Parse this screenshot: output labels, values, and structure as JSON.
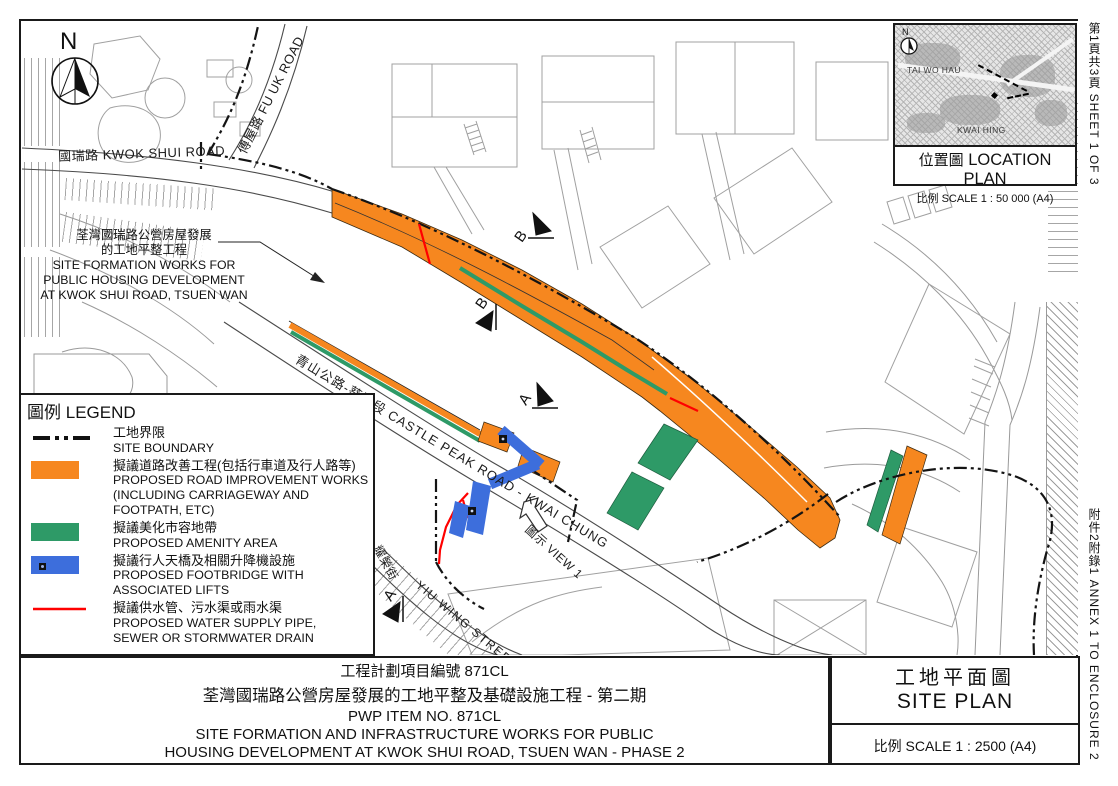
{
  "colors": {
    "road_improvement_orange": "#F6871F",
    "amenity_green": "#2E9A67",
    "footbridge_blue": "#3D6EDC",
    "pipe_red": "#FF0000",
    "boundary_black": "#1A1A1A"
  },
  "north": "N",
  "margin_notes": {
    "sheet": "第1頁共3頁  SHEET 1 OF 3",
    "annex": "附件2附錄1  ANNEX 1 TO ENCLOSURE 2"
  },
  "location_plan": {
    "north": "N",
    "area_label_1": "TAI WO HAU",
    "area_label_2": "KWAI HING",
    "title_zh": "位置圖",
    "title_en": "LOCATION PLAN",
    "scale": "比例 SCALE 1 : 50 000 (A4)"
  },
  "map_labels": {
    "kwok_shui_road": "國瑞路 KWOK SHUI ROAD",
    "fu_uk_road": "傅屋路 FU UK ROAD",
    "castle_peak_road": "青山公路-葵涌段  CASTLE PEAK ROAD - KWAI CHUNG",
    "yiu_wing_street_zh": "耀榮街",
    "yiu_wing_street_en": "YIU WING STREET",
    "view1": "圖示 VIEW 1",
    "section_a": "A",
    "section_b": "B",
    "site_annotation_1": "荃灣國瑞路公營房屋發展",
    "site_annotation_2": "的工地平整工程",
    "site_annotation_3": "SITE FORMATION WORKS FOR",
    "site_annotation_4": "PUBLIC HOUSING DEVELOPMENT",
    "site_annotation_5": "AT KWOK SHUI ROAD, TSUEN WAN"
  },
  "legend": {
    "title_zh": "圖例",
    "title_en": "LEGEND",
    "items": [
      {
        "key": "site-boundary",
        "zh": "工地界限",
        "en": [
          "SITE BOUNDARY"
        ]
      },
      {
        "key": "road-improvement",
        "zh": "擬議道路改善工程(包括行車道及行人路等)",
        "en": [
          "PROPOSED ROAD IMPROVEMENT WORKS",
          "(INCLUDING CARRIAGEWAY AND",
          "FOOTPATH, ETC)"
        ]
      },
      {
        "key": "amenity-area",
        "zh": "擬議美化市容地帶",
        "en": [
          "PROPOSED AMENITY AREA"
        ]
      },
      {
        "key": "footbridge",
        "zh": "擬議行人天橋及相關升降機設施",
        "en": [
          "PROPOSED FOOTBRIDGE WITH",
          "ASSOCIATED LIFTS"
        ]
      },
      {
        "key": "water-pipe",
        "zh": "擬議供水管、污水渠或雨水渠",
        "en": [
          "PROPOSED WATER SUPPLY PIPE,",
          "SEWER OR STORMWATER DRAIN"
        ]
      }
    ]
  },
  "title_block": {
    "project_no_zh": "工程計劃項目編號 871CL",
    "project_title_zh": "荃灣國瑞路公營房屋發展的工地平整及基礎設施工程 - 第二期",
    "project_no_en": "PWP ITEM NO. 871CL",
    "project_title_en_1": "SITE FORMATION AND INFRASTRUCTURE WORKS FOR PUBLIC",
    "project_title_en_2": "HOUSING DEVELOPMENT AT KWOK SHUI ROAD, TSUEN WAN - PHASE 2",
    "drawing_title_zh": "工地平面圖",
    "drawing_title_en": "SITE PLAN",
    "scale": "比例 SCALE 1 : 2500  (A4)"
  }
}
